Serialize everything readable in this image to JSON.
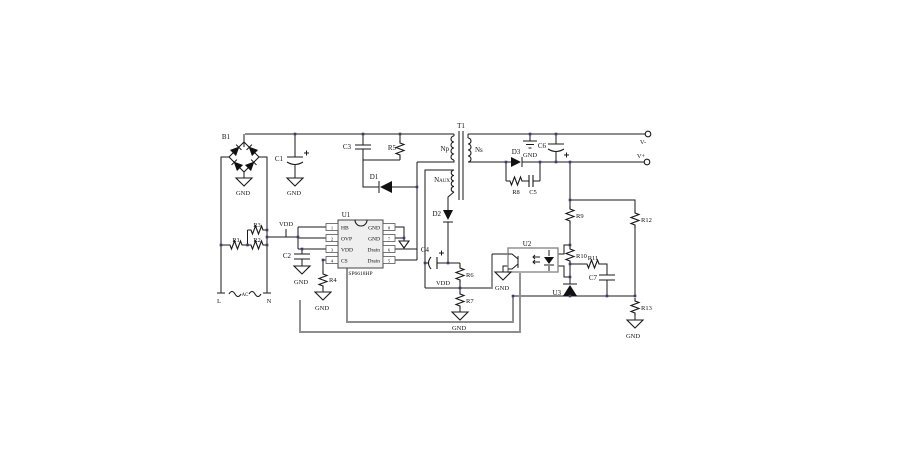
{
  "components": {
    "b1": "B1",
    "t1": "T1",
    "np": "Np",
    "ns": "Ns",
    "naux": "Naux",
    "c1": "C1",
    "c2": "C2",
    "c3": "C3",
    "c4": "C4",
    "c5": "C5",
    "c6": "C6",
    "c7": "C7",
    "r1": "R1",
    "r2": "R2",
    "r3": "R3",
    "r4": "R4",
    "r5": "R5",
    "r6": "R6",
    "r7": "R7",
    "r8": "R8",
    "r9": "R9",
    "r10": "R10",
    "r11": "R11",
    "r12": "R12",
    "r13": "R13",
    "d1": "D1",
    "d2": "D2",
    "d3": "D3",
    "u1": "U1",
    "u1_part": "SP6618HP",
    "u2": "U2",
    "u3": "U3"
  },
  "power_labels": {
    "gnd": "GND",
    "vdd": "VDD"
  },
  "terminals": {
    "live": "L",
    "neutral": "N",
    "ac": "AC",
    "v_minus": "V-",
    "v_plus": "V+"
  },
  "u1_pins": {
    "left": [
      {
        "num": "1",
        "name": "HB"
      },
      {
        "num": "2",
        "name": "OVP"
      },
      {
        "num": "3",
        "name": "VDD"
      },
      {
        "num": "4",
        "name": "CS"
      }
    ],
    "right": [
      {
        "num": "8",
        "name": "GND"
      },
      {
        "num": "7",
        "name": "GND"
      },
      {
        "num": "6",
        "name": "Drain"
      },
      {
        "num": "5",
        "name": "Drain"
      }
    ]
  }
}
